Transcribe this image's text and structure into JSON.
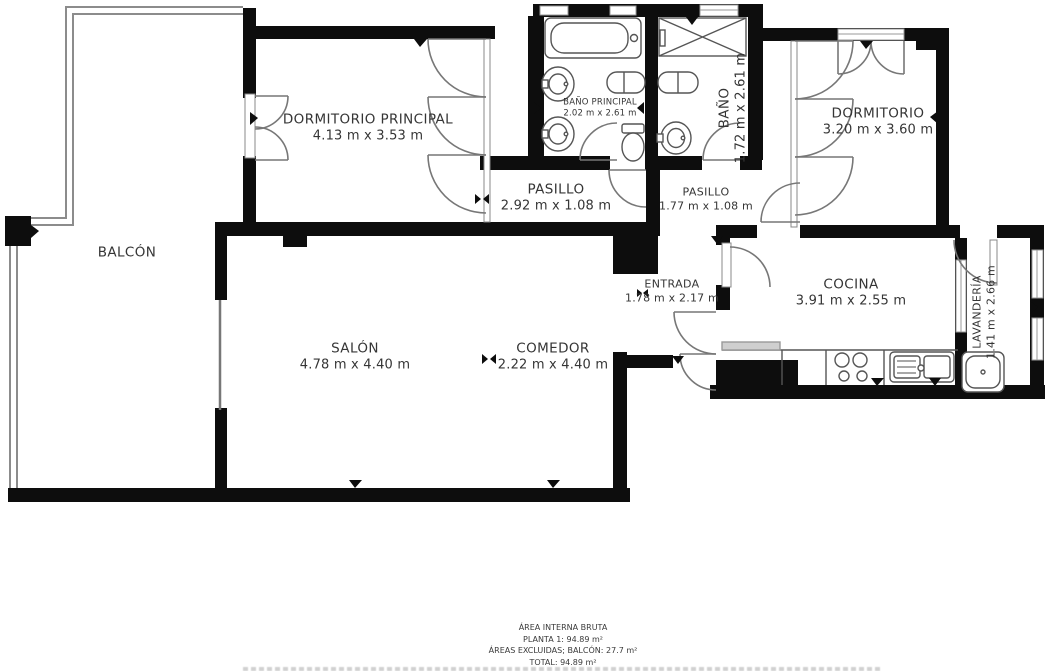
{
  "plan": {
    "rooms": [
      {
        "name": "BALCÓN",
        "dims": ""
      },
      {
        "name": "DORMITORIO PRINCIPAL",
        "dims": "4.13 m x 3.53 m"
      },
      {
        "name": "BAÑO PRINCIPAL",
        "dims": "2.02 m x 2.61 m"
      },
      {
        "name": "BAÑO",
        "dims": "1.72 m x 2.61 m"
      },
      {
        "name": "DORMITORIO",
        "dims": "3.20 m x 3.60 m"
      },
      {
        "name": "PASILLO",
        "dims": "2.92 m x 1.08 m"
      },
      {
        "name": "PASILLO",
        "dims": "1.77 m x 1.08 m"
      },
      {
        "name": "ENTRADA",
        "dims": "1.78 m x 2.17 m"
      },
      {
        "name": "COCINA",
        "dims": "3.91 m x 2.55 m"
      },
      {
        "name": "LAVANDERÍA",
        "dims": "1.41 m x 2.66 m"
      },
      {
        "name": "SALÓN",
        "dims": "4.78 m x 4.40 m"
      },
      {
        "name": "COMEDOR",
        "dims": "2.22 m x 4.40 m"
      }
    ],
    "footer": {
      "line1": "ÁREA INTERNA BRUTA",
      "line2": "PLANTA 1: 94.89 m²",
      "line3": "ÁREAS EXCLUIDAS; BALCÓN: 27.7 m²",
      "line4": "TOTAL: 94.89 m²"
    },
    "colors": {
      "wall": "#0d0d0d",
      "thin_line": "#8c8c8c",
      "door_line": "#777777",
      "label": "#353535"
    }
  }
}
